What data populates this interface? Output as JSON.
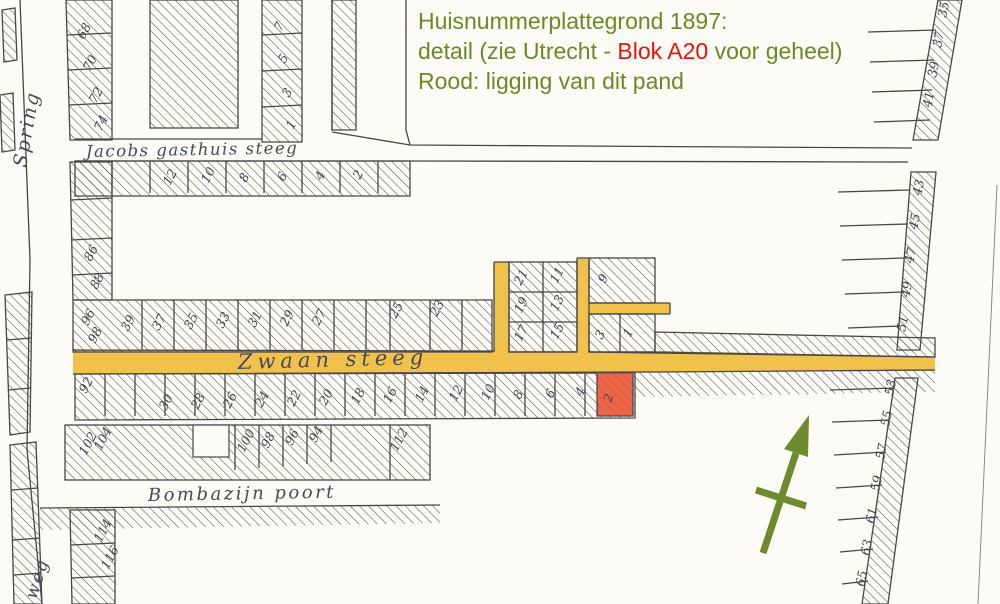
{
  "annotation": {
    "line1": "Huisnummerplattegrond 1897:",
    "line2_prefix": "detail (zie Utrecht - ",
    "line2_highlight": "Blok A20",
    "line2_suffix": " voor geheel)",
    "line3": "Rood: ligging van dit pand"
  },
  "colors": {
    "annotation_green": "#6b8a27",
    "annotation_red": "#e81309",
    "street_highlight_yellow": "#f0c24b",
    "parcel_highlight_red": "#e8502e",
    "north_arrow_olive": "#6d8a2c",
    "map_ink": "#47474b",
    "paper": "#fcfbf6"
  },
  "map": {
    "street_labels": {
      "springweg_upper": "Spring",
      "springweg_lower": "weg",
      "jacobs_gasthuis_steeg": "Jacobs gasthuis steeg",
      "zwaan_steeg": "Zwaan steeg",
      "bombazijn_poort": "Bombazijn poort"
    },
    "highlighted_parcel_number": "2",
    "house_numbers": [
      {
        "t": "68",
        "x": 84,
        "y": 40,
        "r": -62
      },
      {
        "t": "70",
        "x": 90,
        "y": 72,
        "r": -62
      },
      {
        "t": "72",
        "x": 96,
        "y": 104,
        "r": -62
      },
      {
        "t": "74",
        "x": 101,
        "y": 132,
        "r": -62
      },
      {
        "t": "7",
        "x": 281,
        "y": 32,
        "r": -62
      },
      {
        "t": "5",
        "x": 285,
        "y": 64,
        "r": -62
      },
      {
        "t": "3",
        "x": 289,
        "y": 98,
        "r": -62
      },
      {
        "t": "1",
        "x": 293,
        "y": 130,
        "r": -62
      },
      {
        "t": "12",
        "x": 170,
        "y": 186,
        "r": -62
      },
      {
        "t": "10",
        "x": 208,
        "y": 184,
        "r": -62
      },
      {
        "t": "8",
        "x": 246,
        "y": 183,
        "r": -62
      },
      {
        "t": "6",
        "x": 284,
        "y": 182,
        "r": -62
      },
      {
        "t": "4",
        "x": 322,
        "y": 181,
        "r": -62
      },
      {
        "t": "2",
        "x": 360,
        "y": 180,
        "r": -62
      },
      {
        "t": "86",
        "x": 91,
        "y": 262,
        "r": -62
      },
      {
        "t": "88",
        "x": 97,
        "y": 290,
        "r": -62
      },
      {
        "t": "96",
        "x": 88,
        "y": 326,
        "r": -62
      },
      {
        "t": "98",
        "x": 95,
        "y": 344,
        "r": -62
      },
      {
        "t": "39",
        "x": 128,
        "y": 332,
        "r": -62
      },
      {
        "t": "37",
        "x": 159,
        "y": 331,
        "r": -62
      },
      {
        "t": "35",
        "x": 191,
        "y": 330,
        "r": -62
      },
      {
        "t": "33",
        "x": 223,
        "y": 329,
        "r": -62
      },
      {
        "t": "31",
        "x": 255,
        "y": 328,
        "r": -62
      },
      {
        "t": "29",
        "x": 287,
        "y": 327,
        "r": -62
      },
      {
        "t": "27",
        "x": 319,
        "y": 326,
        "r": -62
      },
      {
        "t": "25",
        "x": 396,
        "y": 319,
        "r": -62
      },
      {
        "t": "23",
        "x": 437,
        "y": 317,
        "r": -62
      },
      {
        "t": "21",
        "x": 521,
        "y": 286,
        "r": -62
      },
      {
        "t": "19",
        "x": 521,
        "y": 314,
        "r": -62
      },
      {
        "t": "17",
        "x": 521,
        "y": 342,
        "r": -62
      },
      {
        "t": "11",
        "x": 557,
        "y": 284,
        "r": -62
      },
      {
        "t": "13",
        "x": 557,
        "y": 312,
        "r": -62
      },
      {
        "t": "15",
        "x": 557,
        "y": 340,
        "r": -62
      },
      {
        "t": "9",
        "x": 605,
        "y": 284,
        "r": -62
      },
      {
        "t": "3",
        "x": 602,
        "y": 340,
        "r": -62
      },
      {
        "t": "1",
        "x": 630,
        "y": 338,
        "r": -62
      },
      {
        "t": "4",
        "x": 582,
        "y": 397,
        "r": -62
      },
      {
        "t": "6",
        "x": 552,
        "y": 399,
        "r": -62
      },
      {
        "t": "8",
        "x": 520,
        "y": 400,
        "r": -62
      },
      {
        "t": "10",
        "x": 488,
        "y": 401,
        "r": -62
      },
      {
        "t": "12",
        "x": 456,
        "y": 402,
        "r": -62
      },
      {
        "t": "14",
        "x": 422,
        "y": 403,
        "r": -62
      },
      {
        "t": "16",
        "x": 390,
        "y": 404,
        "r": -62
      },
      {
        "t": "18",
        "x": 358,
        "y": 405,
        "r": -62
      },
      {
        "t": "20",
        "x": 326,
        "y": 406,
        "r": -62
      },
      {
        "t": "22",
        "x": 294,
        "y": 407,
        "r": -62
      },
      {
        "t": "24",
        "x": 262,
        "y": 408,
        "r": -62
      },
      {
        "t": "26",
        "x": 230,
        "y": 409,
        "r": -62
      },
      {
        "t": "28",
        "x": 198,
        "y": 410,
        "r": -62
      },
      {
        "t": "30",
        "x": 166,
        "y": 411,
        "r": -62
      },
      {
        "t": "92",
        "x": 86,
        "y": 394,
        "r": -62
      },
      {
        "t": "102",
        "x": 86,
        "y": 456,
        "r": -62
      },
      {
        "t": "104",
        "x": 101,
        "y": 451,
        "r": -62
      },
      {
        "t": "100",
        "x": 244,
        "y": 453,
        "r": -62
      },
      {
        "t": "98",
        "x": 268,
        "y": 449,
        "r": -62
      },
      {
        "t": "96",
        "x": 292,
        "y": 446,
        "r": -62
      },
      {
        "t": "94",
        "x": 316,
        "y": 443,
        "r": -62
      },
      {
        "t": "112",
        "x": 397,
        "y": 452,
        "r": -62
      },
      {
        "t": "114",
        "x": 101,
        "y": 543,
        "r": -62
      },
      {
        "t": "116",
        "x": 108,
        "y": 570,
        "r": -62
      },
      {
        "t": "35",
        "x": 946,
        "y": 18,
        "r": -78
      },
      {
        "t": "37",
        "x": 941,
        "y": 48,
        "r": -78
      },
      {
        "t": "39",
        "x": 936,
        "y": 78,
        "r": -78
      },
      {
        "t": "41",
        "x": 931,
        "y": 108,
        "r": -78
      },
      {
        "t": "43",
        "x": 921,
        "y": 196,
        "r": -78
      },
      {
        "t": "45",
        "x": 917,
        "y": 230,
        "r": -78
      },
      {
        "t": "47",
        "x": 913,
        "y": 264,
        "r": -78
      },
      {
        "t": "49",
        "x": 909,
        "y": 298,
        "r": -78
      },
      {
        "t": "51",
        "x": 905,
        "y": 332,
        "r": -78
      },
      {
        "t": "53",
        "x": 893,
        "y": 396,
        "r": -78
      },
      {
        "t": "55",
        "x": 889,
        "y": 427,
        "r": -78
      },
      {
        "t": "57",
        "x": 884,
        "y": 460,
        "r": -78
      },
      {
        "t": "59",
        "x": 879,
        "y": 492,
        "r": -78
      },
      {
        "t": "61",
        "x": 874,
        "y": 524,
        "r": -78
      },
      {
        "t": "63",
        "x": 869,
        "y": 556,
        "r": -78
      },
      {
        "t": "65",
        "x": 864,
        "y": 587,
        "r": -78
      }
    ]
  }
}
